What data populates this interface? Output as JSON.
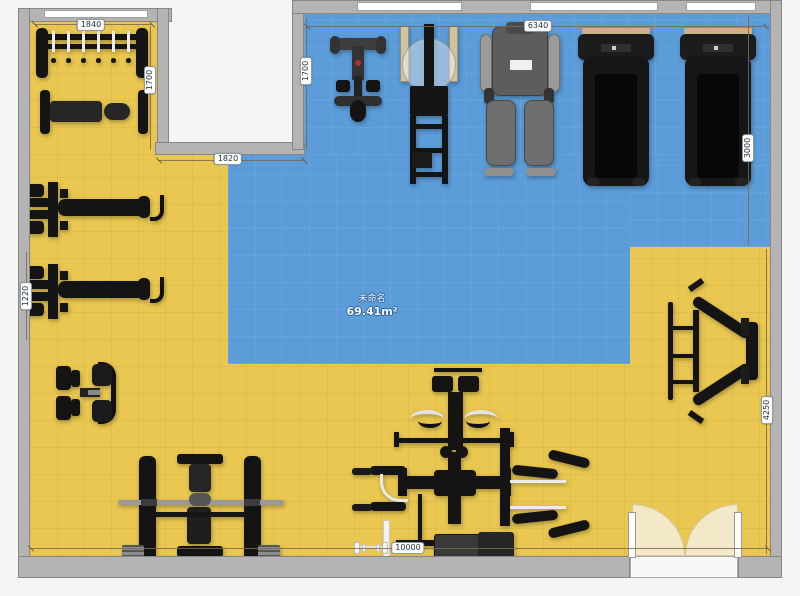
{
  "room": {
    "name": "未命名",
    "area": "69.41m²"
  },
  "dimensions": [
    {
      "name": "rack-wall-width",
      "value": "1840"
    },
    {
      "name": "alcove-depth",
      "value": "1700"
    },
    {
      "name": "notch-width",
      "value": "1820"
    },
    {
      "name": "mat-zone-left-depth",
      "value": "1700"
    },
    {
      "name": "cardio-zone-width",
      "value": "6340"
    },
    {
      "name": "right-upper-depth",
      "value": "3000"
    },
    {
      "name": "right-lower-depth",
      "value": "4250"
    },
    {
      "name": "left-wall-gap",
      "value": "1220"
    },
    {
      "name": "building-width",
      "value": "10000"
    }
  ],
  "colors": {
    "floor": "#e9c750",
    "mat_zone": "#5b9cd9",
    "wall": "#b4b4b4",
    "door_swing": "#f3e9c8",
    "equipment": "#141414"
  },
  "objects": [
    "dumbbell-rack",
    "flat-bench",
    "weight-bench-1",
    "weight-bench-2",
    "pec-deck-machine",
    "squat-rack-bench",
    "multi-station-gym",
    "white-barbell",
    "leg-press-frame",
    "spin-bike",
    "smith-machine",
    "shoulder-press-machine",
    "treadmill-1",
    "treadmill-2",
    "double-door",
    "window"
  ]
}
